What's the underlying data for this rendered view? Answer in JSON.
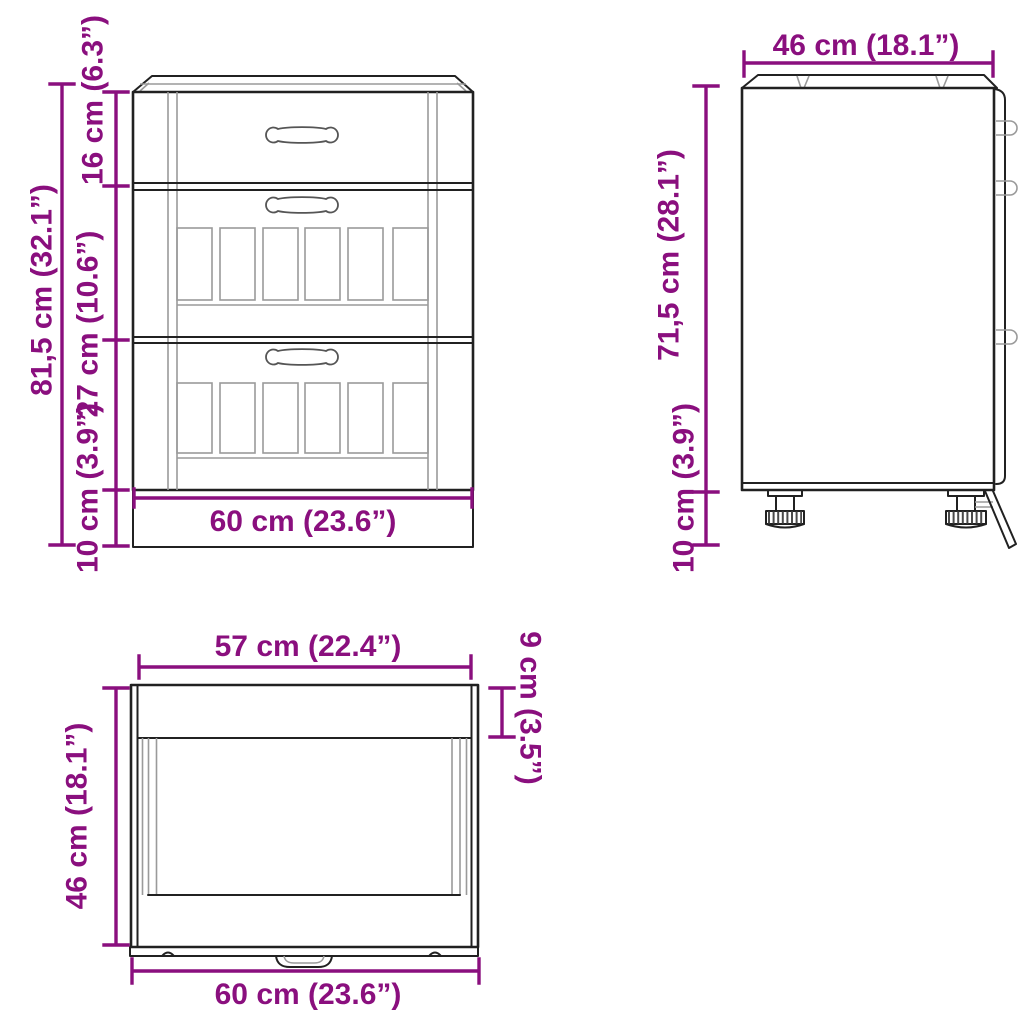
{
  "title": "Kitchen base cabinet dimension diagram",
  "colors": {
    "dimension": "#8a0f7e",
    "ink": "#212121",
    "background": "#ffffff"
  },
  "views": {
    "front": {
      "label": "front view",
      "total_height": "81,5 cm (32.1”)",
      "top_drawer_height": "16 cm (6.3”)",
      "drawer_height": "27 cm (10.6”)",
      "plinth_height": "10 cm (3.9”)",
      "width": "60 cm (23.6”)"
    },
    "side": {
      "label": "side view",
      "depth": "46 cm (18.1”)",
      "body_height": "71,5 cm (28.1”)",
      "feet_height": "10 cm (3.9”)"
    },
    "top": {
      "label": "top view",
      "front_width": "57 cm (22.4”)",
      "front_edge_depth": "9 cm (3.5”)",
      "depth": "46 cm (18.1”)",
      "width": "60 cm (23.6”)"
    }
  }
}
